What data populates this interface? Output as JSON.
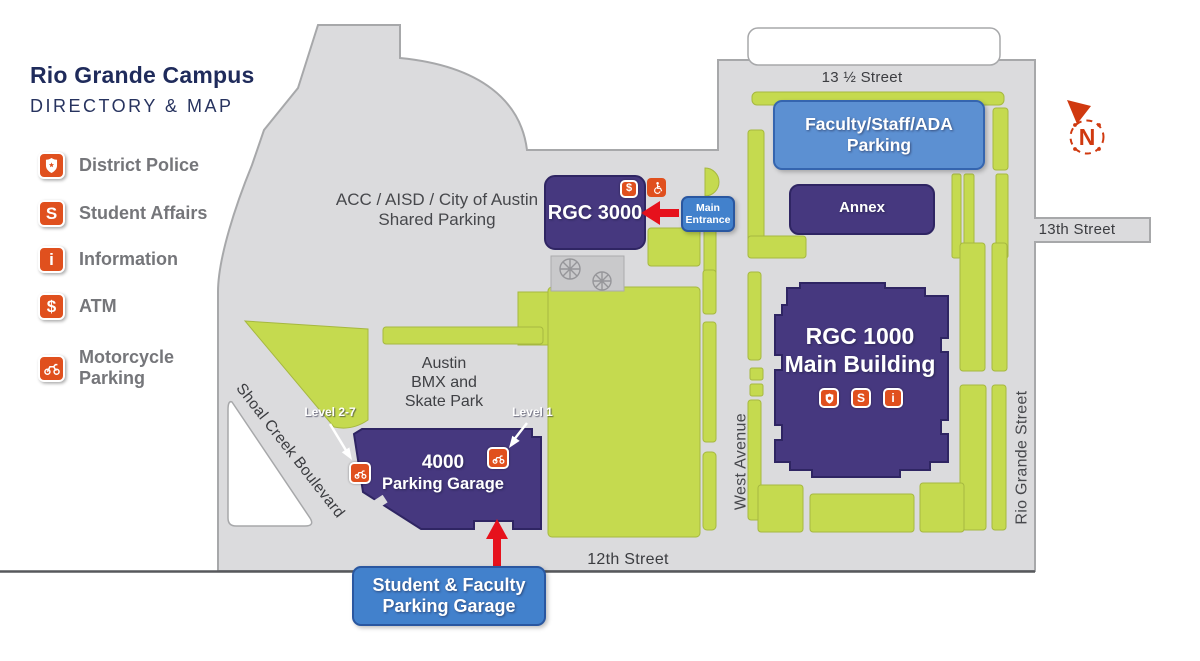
{
  "header": {
    "title": "Rio Grande Campus",
    "subtitle": "DIRECTORY & MAP"
  },
  "legend": {
    "items": [
      {
        "icon": "police-badge-icon",
        "label": "District Police"
      },
      {
        "icon": "student-affairs-icon",
        "label": "Student Affairs",
        "symbol": "S"
      },
      {
        "icon": "information-icon",
        "label": "Information",
        "symbol": "i"
      },
      {
        "icon": "atm-icon",
        "label": "ATM",
        "symbol": "$"
      },
      {
        "icon": "motorcycle-parking-icon",
        "label": "Motorcycle Parking"
      }
    ]
  },
  "map": {
    "streets": {
      "thirteen_half": "13 ½ Street",
      "thirteenth": "13th Street",
      "twelfth": "12th Street",
      "west_avenue": "West Avenue",
      "rio_grande": "Rio Grande Street",
      "shoal_creek": "Shoal Creek Boulevard"
    },
    "areas": {
      "shared_parking": {
        "line1": "ACC / AISD / City of Austin",
        "line2": "Shared Parking"
      },
      "skate_park": {
        "line1": "Austin",
        "line2": "BMX and",
        "line3": "Skate Park"
      }
    },
    "buildings": {
      "rgc3000": {
        "name": "RGC 3000"
      },
      "annex": {
        "name": "Annex"
      },
      "rgc1000": {
        "line1": "RGC 1000",
        "line2": "Main Building"
      },
      "garage4000": {
        "line1": "4000",
        "line2": "Parking Garage"
      }
    },
    "callouts": {
      "faculty_parking": {
        "line1": "Faculty/Staff/ADA",
        "line2": "Parking"
      },
      "main_entrance": {
        "line1": "Main",
        "line2": "Entrance"
      },
      "student_garage": {
        "line1": "Student & Faculty",
        "line2": "Parking Garage"
      },
      "level_2_7": "Level 2-7",
      "level_1": "Level 1"
    },
    "symbols": {
      "atm": "$",
      "student_affairs": "S",
      "information": "i",
      "north": "N"
    },
    "colors": {
      "building_purple": "#46387F",
      "parking_green": "#C5DA4F",
      "street_gray": "#DBDBDD",
      "callout_blue": "#4281CC",
      "accent_orange": "#E0501E",
      "arrow_red": "#E6111C",
      "title_navy": "#1F2B5B",
      "compass_red": "#D0390F"
    }
  }
}
